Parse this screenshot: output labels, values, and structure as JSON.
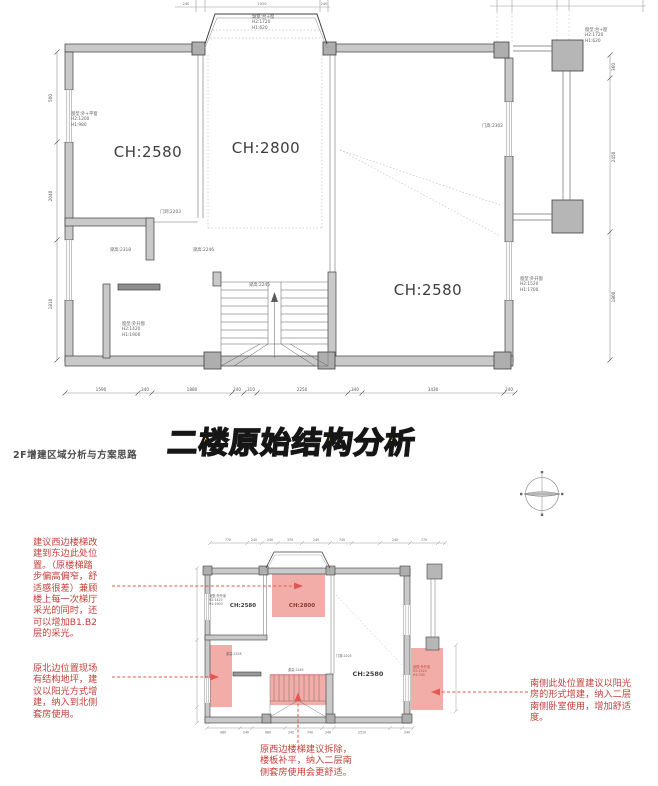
{
  "title": {
    "text": "二楼原始结构分析"
  },
  "section_label": {
    "text": "2F增建区域分析与方案思路"
  },
  "colors": {
    "highlight_pink": "#ef8e87",
    "annotation_red": "#c4403a",
    "arrow_red": "#e2574f",
    "title_yellow": "#f6cf39",
    "wall_gray": "#c9c9c9"
  },
  "upper_plan": {
    "ch_rooms": [
      "CH:2580",
      "CH:2800",
      "CH:2580"
    ],
    "labels": {
      "win_left": "窗型:外+平窗\nH2:1200\nH1:980",
      "bay": "飘窗:台+窗\nH2:1720\nH1:620",
      "win_right_top": "窗型:台+窗\nH2:1720\nH1:620",
      "beam1": "梁高:2318",
      "beam2": "梁高:2246",
      "beam3": "梁高:2245",
      "door1": "门洞:2203",
      "door2": "门高:2302",
      "win_bottom_left": "窗型:外开窗\nH2:1420\nH1:1900",
      "win_right": "窗型:外开窗\nH2:1520\nH1:1700"
    },
    "dims_top": [
      "240",
      "1020",
      "240"
    ],
    "dims_bottom": [
      "1590",
      "340",
      "1880",
      "240",
      "310",
      "2250",
      "340",
      "3430",
      "240"
    ],
    "dims_left": [
      "500",
      "2040",
      "1810"
    ],
    "dims_right": [
      "360",
      "2450",
      "1800"
    ]
  },
  "lower_plan": {
    "ch_rooms": [
      "CH:2580",
      "CH:2800",
      "CH:2580"
    ],
    "labels": {
      "win_left": "窗型:外开窗\nH2:1420\nH1:1900",
      "beam1": "梁高:2318",
      "beam2": "梁高:2245",
      "door1": "门洞:2203",
      "win_right": "窗型:外开窗\nH2:1520\nH1:700"
    },
    "dims_top": [
      "770",
      "240",
      "240",
      "370",
      "240",
      "740",
      "240",
      "770"
    ],
    "dims_bottom": [
      "980",
      "240",
      "980",
      "240",
      "740",
      "240",
      "2510",
      "240"
    ]
  },
  "annotations": {
    "stair_relocate": "建议西边楼梯改\n建到东边此处位\n置。（原楼梯踏\n步偏高偏窄，舒\n适感很差）兼顾\n楼上每一次梯厅\n采光的同时，还\n可以增加B1.B2\n层的采光。",
    "north_platform": "原北边位置现场\n有结构地坪，建\n议以阳光方式增\n建，纳入到北侧\n套房使用。",
    "south_sunroom": "南侧此处位置建议以阳光\n房的形式增建，纳入二层\n南侧卧室使用，增加舒适\n度。",
    "old_stair_remove": "原西边楼梯建议拆除，\n楼板补平，纳入二层南\n侧套房使用会更舒适。"
  }
}
